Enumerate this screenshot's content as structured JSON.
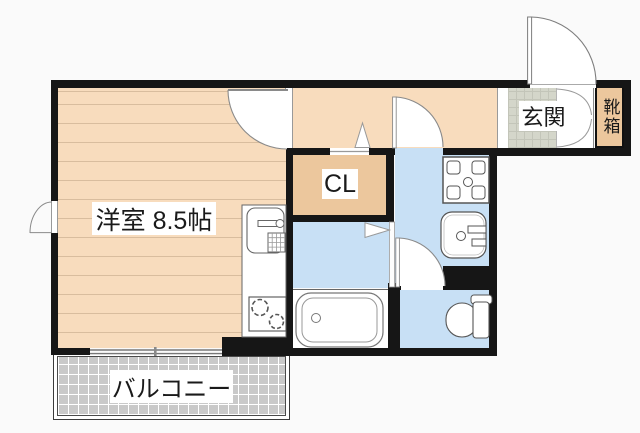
{
  "plan": {
    "type": "apartment-floor-plan",
    "labels": {
      "main_room": "洋室 8.5帖",
      "closet": "CL",
      "entrance": "玄関",
      "shoe_box": "靴箱",
      "balcony": "バルコニー"
    },
    "colors": {
      "flooring": "#f8dcbd",
      "flooring_stripe": "#d9bd9e",
      "closet_fill": "#ecc79d",
      "wet_area_fill": "#c8e0f5",
      "entrance_tile": "#d4d6ca",
      "balcony_fill": "#c9c9c9",
      "wall": "#161616",
      "background": "#fafafa"
    },
    "fixture_icons": [
      "kitchen-sink-icon",
      "gas-stove-icon",
      "washing-machine-pan-icon",
      "washbasin-icon",
      "bathtub-icon",
      "toilet-icon",
      "door-swing-icon"
    ]
  }
}
